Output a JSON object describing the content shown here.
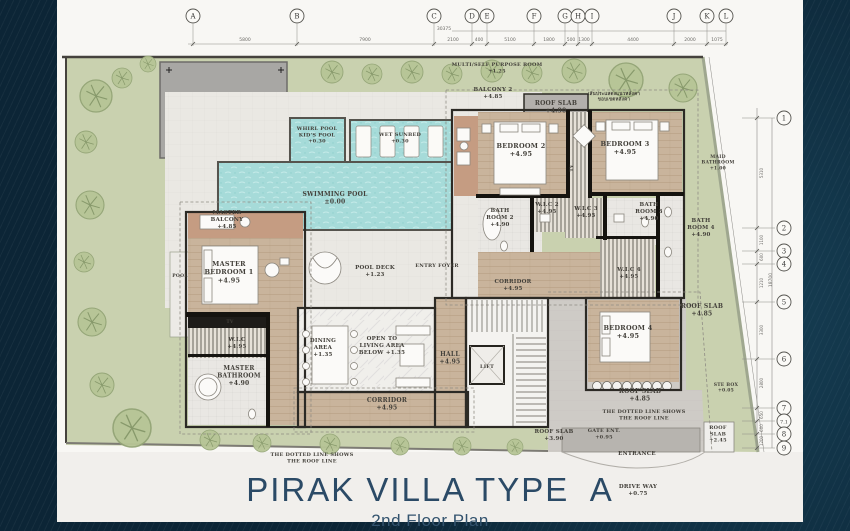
{
  "title_block": {
    "title": "PIRAK VILLA TYPE  A",
    "subtitle": "2nd Floor Plan"
  },
  "colors": {
    "background_navy": "#0c2536",
    "paper": "#f8f7f4",
    "garden_green": "#c9d1af",
    "pool_water": "#a6dbd9",
    "wood_floor": "#c9b49c",
    "roof_gray": "#cecbc6",
    "wall_dark": "#2c2a25",
    "title_blue": "#2b4a66"
  },
  "plan": {
    "grid": {
      "columns": [
        {
          "l": "A",
          "x": 193
        },
        {
          "l": "B",
          "x": 297
        },
        {
          "l": "C",
          "x": 434
        },
        {
          "l": "D",
          "x": 472
        },
        {
          "l": "E",
          "x": 487
        },
        {
          "l": "F",
          "x": 534
        },
        {
          "l": "G",
          "x": 565
        },
        {
          "l": "H",
          "x": 578
        },
        {
          "l": "I",
          "x": 592
        },
        {
          "l": "J",
          "x": 674
        },
        {
          "l": "K",
          "x": 707
        },
        {
          "l": "L",
          "x": 726
        }
      ],
      "top_dims": [
        {
          "t": "5800",
          "x": 245
        },
        {
          "t": "7900",
          "x": 365
        },
        {
          "t": "2100",
          "x": 453
        },
        {
          "t": "400",
          "x": 479
        },
        {
          "t": "5100",
          "x": 510
        },
        {
          "t": "1800",
          "x": 549
        },
        {
          "t": "500",
          "x": 571
        },
        {
          "t": "1300",
          "x": 584
        },
        {
          "t": "4400",
          "x": 633
        },
        {
          "t": "2000",
          "x": 690
        },
        {
          "t": "1075",
          "x": 717
        }
      ],
      "overall_width": {
        "t": "30375",
        "x": 444,
        "y": 30
      },
      "rows": [
        {
          "l": "1",
          "y": 118
        },
        {
          "l": "2",
          "y": 228
        },
        {
          "l": "3",
          "y": 251
        },
        {
          "l": "4",
          "y": 264
        },
        {
          "l": "5",
          "y": 302
        },
        {
          "l": "6",
          "y": 359
        },
        {
          "l": "7",
          "y": 408
        },
        {
          "l": "7.1",
          "y": 421
        },
        {
          "l": "8",
          "y": 434
        },
        {
          "l": "9",
          "y": 448
        }
      ],
      "right_dims": [
        {
          "t": "5310",
          "y": 173
        },
        {
          "t": "1100",
          "y": 240
        },
        {
          "t": "600",
          "y": 257
        },
        {
          "t": "1210",
          "y": 283
        },
        {
          "t": "3300",
          "y": 330
        },
        {
          "t": "2800",
          "y": 383
        },
        {
          "t": "650",
          "y": 415
        },
        {
          "t": "600",
          "y": 428
        },
        {
          "t": "1200",
          "y": 441
        }
      ],
      "overall_height": {
        "t": "18700",
        "x": 772,
        "y": 280
      }
    },
    "labels": [
      {
        "t": "MULTI/SELF PURPOSE ROOM|+1.25",
        "x": 497,
        "y": 66,
        "s": 5,
        "c": "#7e8a69"
      },
      {
        "t": "BALCONY 2|+4.85",
        "x": 493,
        "y": 91,
        "s": 5.5
      },
      {
        "t": "ROOF SLAB|+4.90",
        "x": 556,
        "y": 105,
        "s": 6
      },
      {
        "t": "เส้นประแสดงแนวหลังคา|ขอบเขตหลังคา",
        "x": 614,
        "y": 95,
        "s": 4.5,
        "c": "#8b887e"
      },
      {
        "t": "WHIRL POOL|KID'S POOL|+0.30",
        "x": 317,
        "y": 130,
        "s": 5,
        "c": "#4e6a6a"
      },
      {
        "t": "WET SUNBED|+0.30",
        "x": 400,
        "y": 136,
        "s": 5,
        "c": "#4e6a6a"
      },
      {
        "t": "SWIMMING POOL|±0.00",
        "x": 335,
        "y": 196,
        "s": 6,
        "c": "#4e6a6a"
      },
      {
        "t": "BEDROOM 2|+4.95",
        "x": 521,
        "y": 148,
        "s": 6.5
      },
      {
        "t": "BEDROOM 3|+4.95",
        "x": 625,
        "y": 146,
        "s": 6.5
      },
      {
        "t": "TV",
        "x": 573,
        "y": 168,
        "s": 4.5,
        "r": -90
      },
      {
        "t": "MAID|BATHROOM|+1.00",
        "x": 718,
        "y": 158,
        "s": 4.5,
        "c": "#96a386"
      },
      {
        "t": "BATH|ROOM 2|+4.90",
        "x": 500,
        "y": 212,
        "s": 5.5
      },
      {
        "t": "W.I.C 2|+4.95",
        "x": 547,
        "y": 206,
        "s": 5.5
      },
      {
        "t": "W.I.C 3|+4.95",
        "x": 586,
        "y": 210,
        "s": 5.5
      },
      {
        "t": "BATH|ROOM 3|+4.90",
        "x": 649,
        "y": 206,
        "s": 5.5
      },
      {
        "t": "BATH|ROOM 4|+4.90",
        "x": 701,
        "y": 222,
        "s": 5.5,
        "c": "#5d6b4f"
      },
      {
        "t": "MASTER|BALCONY|+4.85",
        "x": 227,
        "y": 214,
        "s": 5.5
      },
      {
        "t": "MASTER|BEDROOM 1|+4.95",
        "x": 229,
        "y": 266,
        "s": 6.5
      },
      {
        "t": "POOL",
        "x": 180,
        "y": 277,
        "s": 4.5,
        "c": "#6a7a68"
      },
      {
        "t": "POOL DECK|+1.23",
        "x": 375,
        "y": 269,
        "s": 5.5,
        "c": "#8f8a7d"
      },
      {
        "t": "ENTRY FOYER",
        "x": 437,
        "y": 267,
        "s": 5,
        "c": "#8f8a7d"
      },
      {
        "t": "CORRIDOR|+4.95",
        "x": 513,
        "y": 283,
        "s": 5.5
      },
      {
        "t": "W.I.C 4|+4.95",
        "x": 629,
        "y": 271,
        "s": 5.5
      },
      {
        "t": "TV",
        "x": 230,
        "y": 323,
        "s": 4.5,
        "c": "#efece6"
      },
      {
        "t": "W.I.C|+4.95",
        "x": 237,
        "y": 341,
        "s": 5.5
      },
      {
        "t": "DINING|AREA|+1.35",
        "x": 323,
        "y": 342,
        "s": 5.5
      },
      {
        "t": "OPEN TO|LIVING AREA|BELOW +1.35",
        "x": 382,
        "y": 340,
        "s": 5.5
      },
      {
        "t": "HALL|+4.95",
        "x": 450,
        "y": 356,
        "s": 6
      },
      {
        "t": "LIFT",
        "x": 487,
        "y": 368,
        "s": 5
      },
      {
        "t": "BEDROOM 4|+4.95",
        "x": 628,
        "y": 330,
        "s": 6.5
      },
      {
        "t": "ROOF SLAB|+4.85",
        "x": 702,
        "y": 308,
        "s": 6
      },
      {
        "t": "MASTER|BATHROOM|+4.90",
        "x": 239,
        "y": 370,
        "s": 6
      },
      {
        "t": "CORRIDOR|+4.95",
        "x": 387,
        "y": 402,
        "s": 6
      },
      {
        "t": "ROOF SLAB|+4.85",
        "x": 640,
        "y": 393,
        "s": 6
      },
      {
        "t": "THE DOTTED LINE SHOWS|THE ROOF LINE",
        "x": 644,
        "y": 413,
        "s": 5
      },
      {
        "t": "ROOF SLAB|+3.90",
        "x": 554,
        "y": 433,
        "s": 5.5
      },
      {
        "t": "GATE ENT.|+0.95",
        "x": 604,
        "y": 432,
        "s": 5,
        "c": "#8f8a7d"
      },
      {
        "t": "ROOF|SLAB|+2.45",
        "x": 718,
        "y": 429,
        "s": 5
      },
      {
        "t": "ENTRANCE",
        "x": 637,
        "y": 455,
        "s": 5.5,
        "c": "#9a958a"
      },
      {
        "t": "THE DOTTED LINE SHOWS|THE ROOF LINE",
        "x": 312,
        "y": 456,
        "s": 5,
        "c": "#9a958a"
      },
      {
        "t": "DRIVE WAY|+0.75",
        "x": 638,
        "y": 488,
        "s": 5.5,
        "c": "#b9b5ad"
      },
      {
        "t": "STE BOX|+0.05",
        "x": 726,
        "y": 386,
        "s": 4.5,
        "c": "#96a386"
      }
    ]
  }
}
